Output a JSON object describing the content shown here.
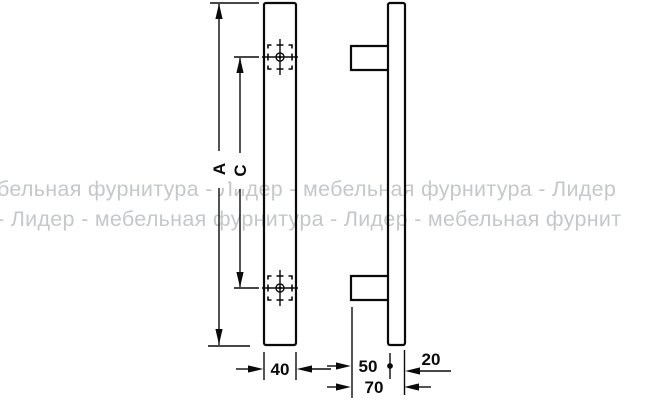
{
  "title": "furniture-handle-dimension-drawing",
  "watermark": {
    "line1": "бельная фурнитура - Лидер - мебельная фурнитура - Лидер",
    "line2": "- Лидер - мебельная фурнитура - Лидер - мебельная фурнит",
    "color": "#c5c8ca"
  },
  "colors": {
    "background": "#ffffff",
    "line": "#0a0a0a",
    "watermark": "#c5c8ca"
  },
  "dimensions": {
    "front_view": {
      "overall_length_label": "A",
      "hole_spacing_label": "C",
      "bar_width": "40"
    },
    "side_view": {
      "projection": "50",
      "total_depth": "70",
      "bar_thickness": "20"
    }
  }
}
